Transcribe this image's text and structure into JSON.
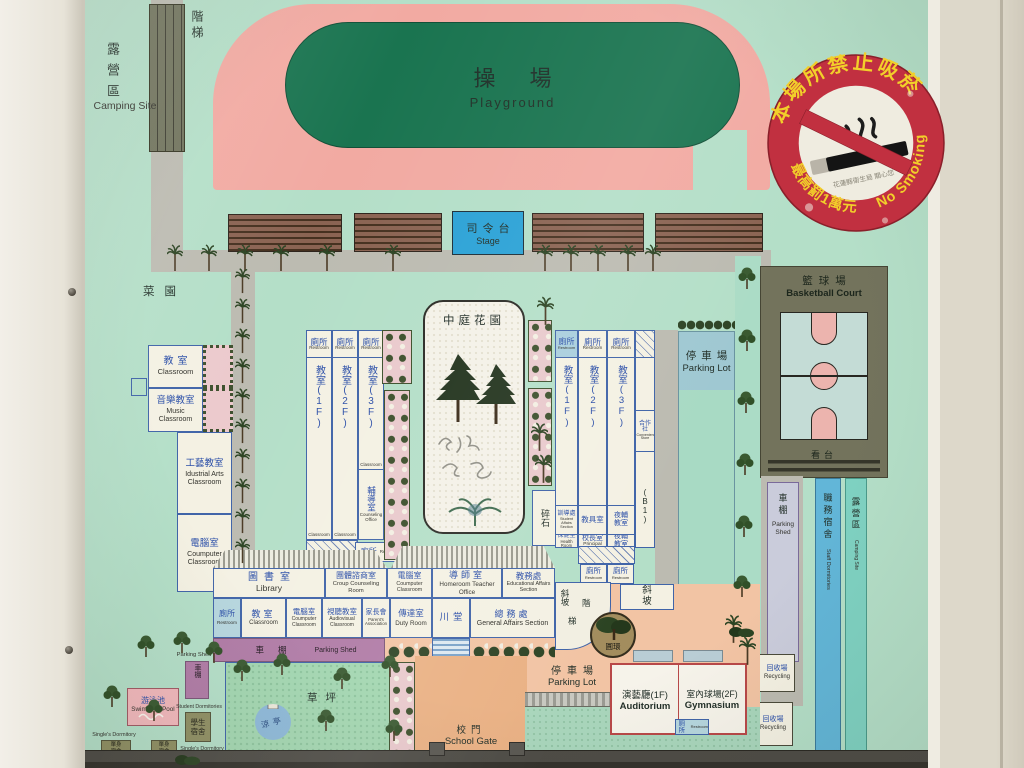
{
  "top": {
    "stairs": "階梯",
    "camping": {
      "zh": "露營區",
      "en": "Camping Site"
    },
    "playground": {
      "zh": "操場",
      "en": "Playground"
    },
    "stage": {
      "zh": "司令台",
      "en": "Stage"
    },
    "grandstand": "看台",
    "garden": "菜園"
  },
  "west": {
    "classroom": {
      "zh": "教室",
      "en": "Classroom"
    },
    "music": {
      "zh": "音樂教室",
      "en": "Music Classroom"
    },
    "industrial": {
      "zh": "工藝教室",
      "en": "Idustrial Arts Classroom"
    },
    "computer": {
      "zh": "電腦室",
      "en": "Coumputer Classroom"
    }
  },
  "common": {
    "restroom": {
      "zh": "廁所",
      "en": "Restroom"
    },
    "classroom_en": "Classroom"
  },
  "west_bldg": {
    "f1": "教室(1F)",
    "f2": "教室(2F)",
    "f3": "教室(3F)",
    "counseling": {
      "zh": "輔導室",
      "en": "Counseling Office"
    }
  },
  "courtyard": {
    "title": "中庭花園"
  },
  "gravel": "碎石",
  "east_bldg": {
    "f1": "教室(1F)",
    "f2": "教室(2F)",
    "f3": "教室(3F)",
    "coop": {
      "zh": "合作社",
      "en": "Convenience Store"
    },
    "b1": "(B1)",
    "student_affairs": {
      "zh": "訓導處",
      "en": "Student Affairs Section"
    },
    "teaching_aids": "教具室",
    "night_class": "夜輔教室",
    "health": {
      "zh": "保健室",
      "en": "Health Room"
    },
    "principal": {
      "zh": "校長室",
      "en": "Principal"
    }
  },
  "east": {
    "parking": {
      "zh": "停車場",
      "en": "Parking Lot"
    },
    "basketball": {
      "zh": "籃球場",
      "en": "Basketball Court"
    },
    "grandstand": "看台",
    "shed": {
      "zh": "車棚",
      "en": "Parking Shed"
    },
    "staff_dorm": {
      "zh": "職務宿舍",
      "en": "Staff Dormitories"
    },
    "camping": {
      "zh": "露營區",
      "en": "Camping Site"
    },
    "recycling": {
      "zh": "回收場",
      "en": "Recycling"
    }
  },
  "south_bldg": {
    "library": {
      "zh": "圖書室",
      "en": "Library"
    },
    "group_counseling": {
      "zh": "團體諮商室",
      "en": "Croup Counseling Room"
    },
    "computer1": {
      "zh": "電腦室",
      "en": "Coumputer Classroom"
    },
    "homeroom": {
      "zh": "導師室",
      "en": "Homeroom Teacher Office"
    },
    "edu_affairs": {
      "zh": "教務處",
      "en": "Educational Affairs Section"
    },
    "classroom": {
      "zh": "教室",
      "en": "Classroom"
    },
    "computer2": {
      "zh": "電腦室",
      "en": "Coumputer Classroom"
    },
    "audiovisual": {
      "zh": "視聽教室",
      "en": "Audiovisual Classroom"
    },
    "parents": {
      "zh": "家長會",
      "en": "Parent's Association"
    },
    "duty": {
      "zh": "傳達室",
      "en": "Duty Room"
    },
    "hall": "川堂",
    "general": {
      "zh": "總務處",
      "en": "General Affairs Section"
    },
    "shed": {
      "zh": "車棚",
      "en": "Parking Shed"
    }
  },
  "paths": {
    "ramp": "斜坡",
    "stair1": "階",
    "stair2": "梯",
    "roundabout": "圓環"
  },
  "southwest": {
    "pool": {
      "zh": "游泳池",
      "en": "Swimming Pool"
    },
    "shed": {
      "zh": "車棚",
      "en": "Parking Shed"
    },
    "student_dorm": {
      "zh": "學生宿舍",
      "en": "Student Dormitories"
    },
    "singles": {
      "zh": "單身宿舍",
      "en": "Single's Dormitory"
    },
    "lawn": "草坪",
    "pavilion": "涼亭"
  },
  "south": {
    "gate": {
      "zh": "校門",
      "en": "School Gate"
    },
    "parking": {
      "zh": "停車場",
      "en": "Parking Lot"
    },
    "auditorium": {
      "zh": "演藝廳(1F)",
      "en": "Auditorium"
    },
    "gym": {
      "zh": "室內球場(2F)",
      "en": "Gymnasium"
    }
  },
  "sticker": {
    "top": "本場所禁止吸菸",
    "bottom_left": "最高罰1萬元",
    "bottom_right": "No Smoking",
    "note": "花蓮縣衛生局 關心您"
  },
  "colors": {
    "accent_red": "#c13040",
    "map_green": "#b4dfc8",
    "track_pink": "#f2aaa2",
    "field_green": "#1a7450",
    "stage_blue": "#2ba2d6"
  }
}
